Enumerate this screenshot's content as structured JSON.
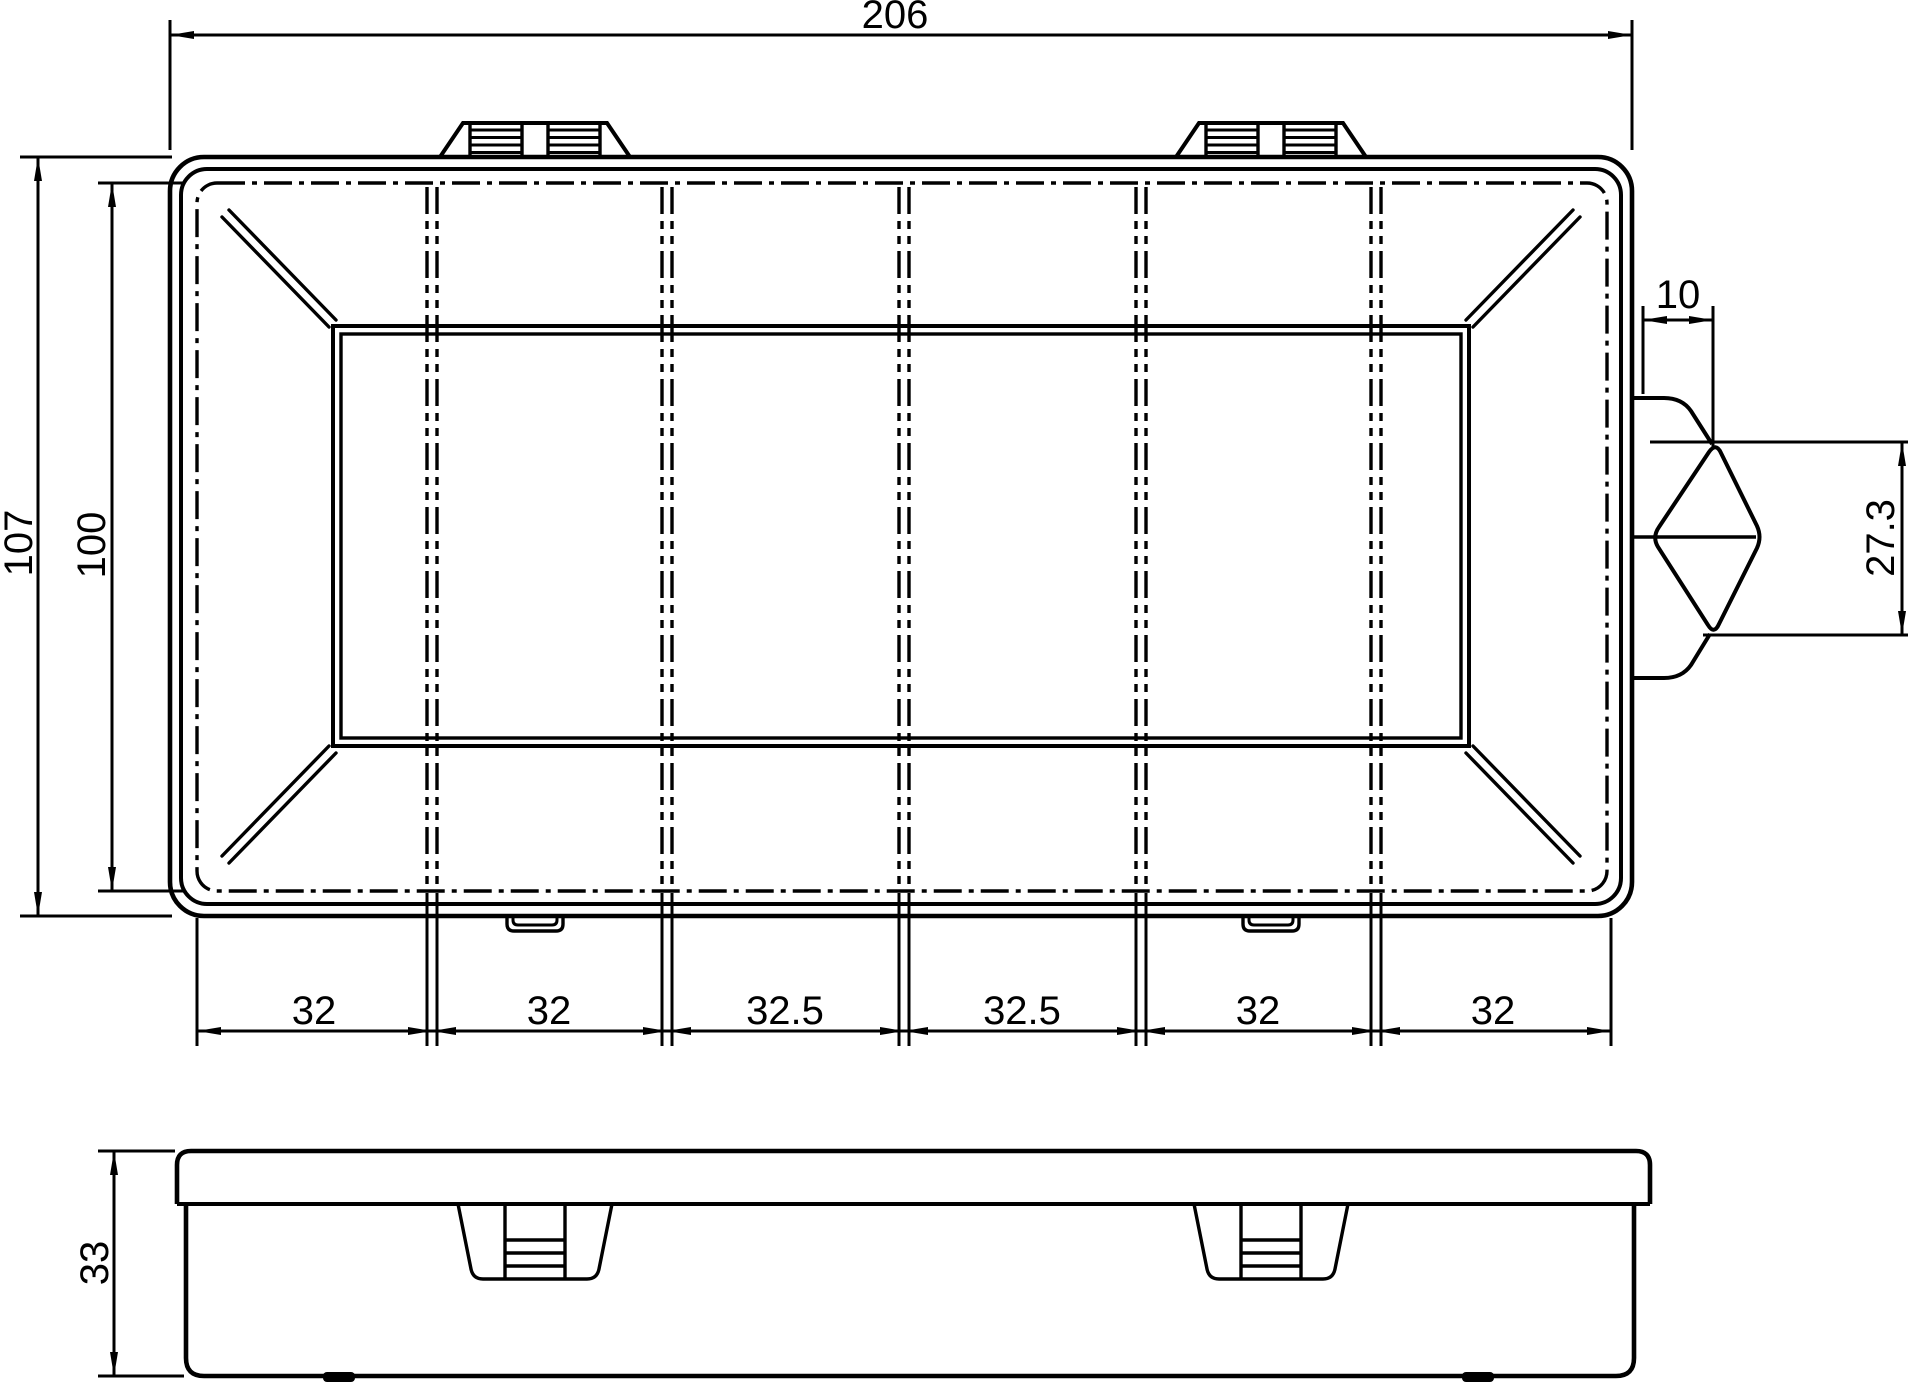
{
  "page": {
    "background": "#ffffff",
    "line_color": "#000000",
    "drawing_type": "technical dimension drawing of a 6-compartment organizer box"
  },
  "dimensions": {
    "overall_width": "206",
    "overall_height": "107",
    "inner_height": "100",
    "clasp_offset": "10",
    "clasp_height": "27.3",
    "box_height": "33",
    "compartment_widths": [
      "32",
      "32",
      "32.5",
      "32.5",
      "32",
      "32"
    ]
  }
}
